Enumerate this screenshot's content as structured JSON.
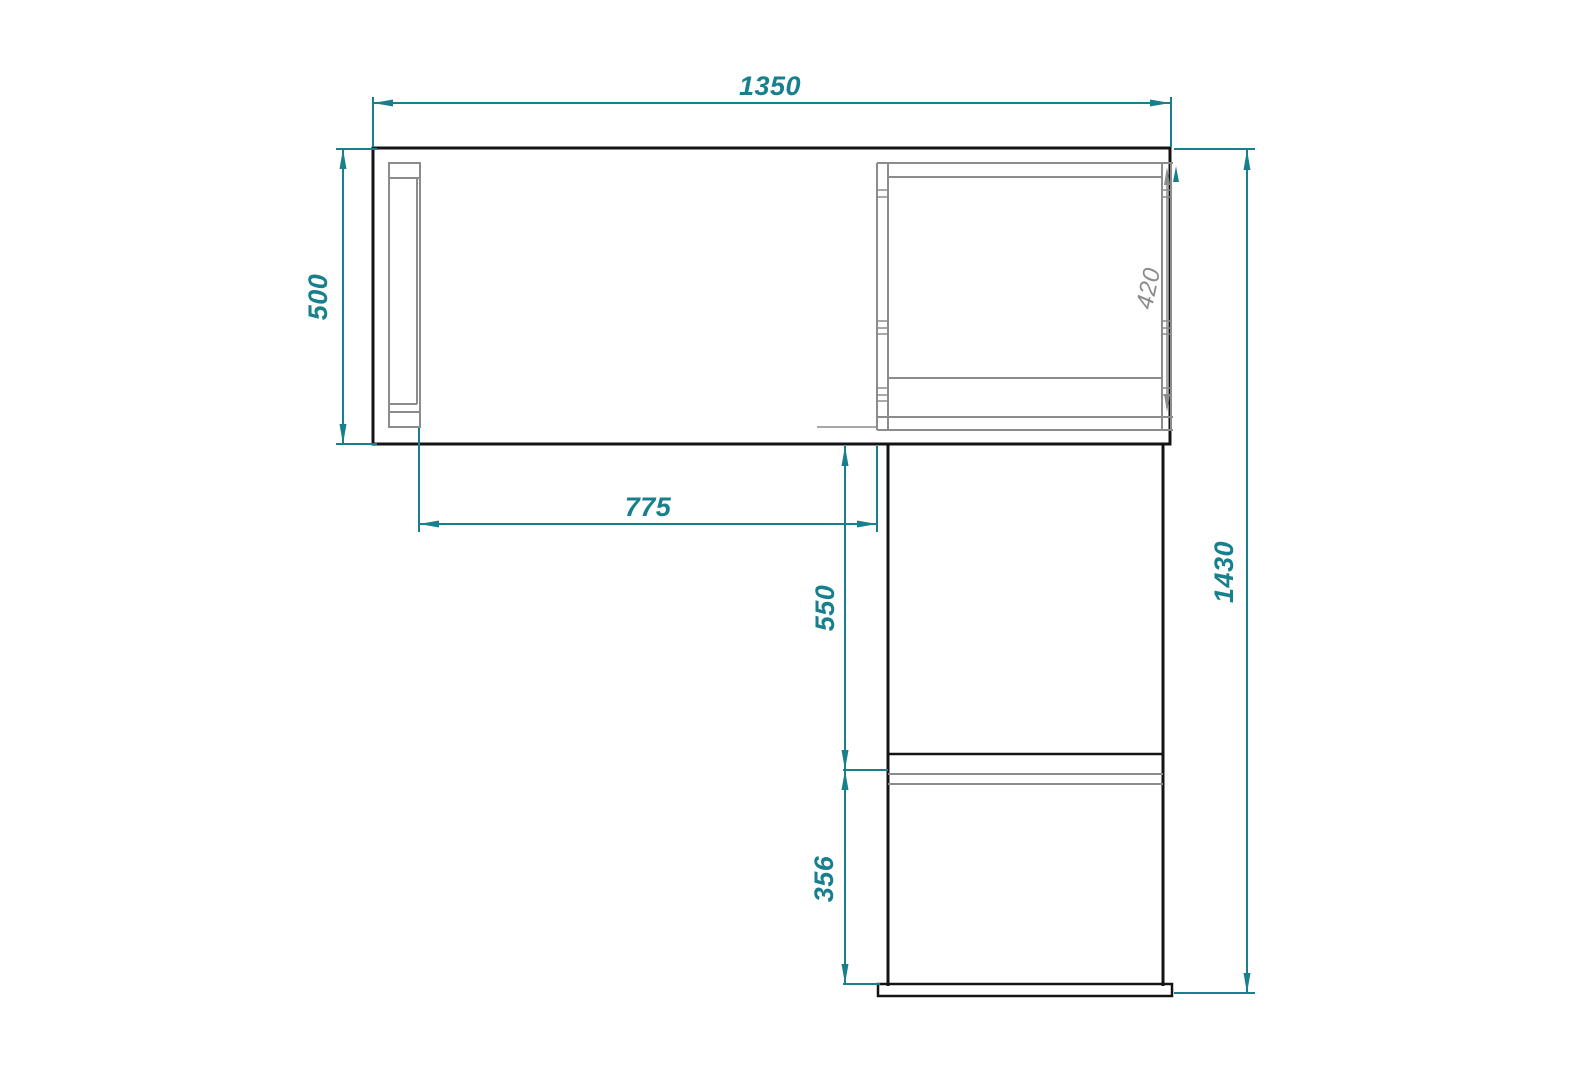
{
  "drawing": {
    "type": "furniture dimension drawing (corner desk / cabinet side view)",
    "dims": {
      "overall_width": "1350",
      "side_height": "500",
      "left_section_width": "775",
      "middle_section_height": "550",
      "bottom_section_height": "356",
      "overall_height": "1430",
      "inner_opening_height": "420"
    },
    "colors": {
      "dimension_accent": "#17808c",
      "outline": "#141414",
      "secondary_lines": "#8c8c8c",
      "background": "#ffffff"
    }
  }
}
